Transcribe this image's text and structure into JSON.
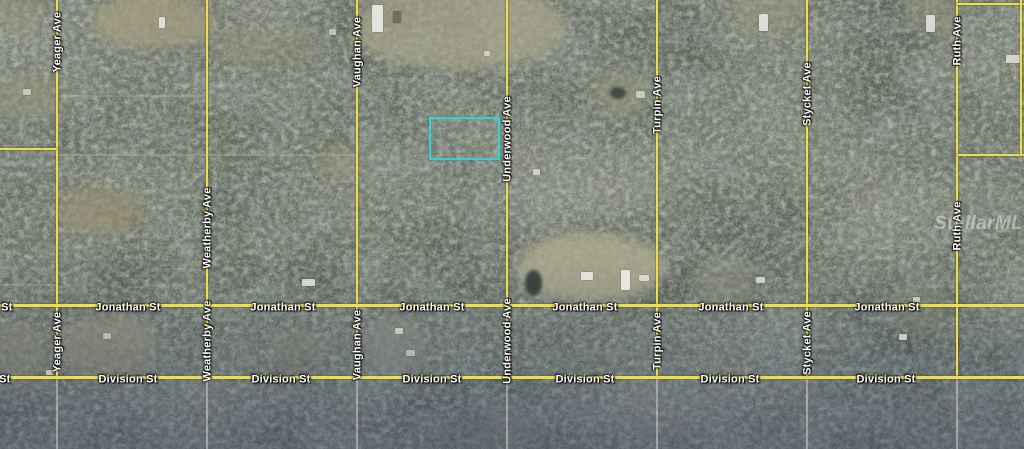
{
  "map": {
    "watermark": "StellarMLS",
    "watermark_pos": {
      "x": 934,
      "y": 213
    },
    "palette": {
      "forest_base": "#4d564c",
      "road_yellow": "#ecdf4e",
      "road_dirt": "#d0d0c4",
      "label_text": "#ffffff",
      "highlight": "#32d2d4"
    },
    "highlight_parcel": {
      "x": 429,
      "y": 117,
      "w": 71,
      "h": 43
    },
    "avenues": [
      {
        "name": "Yeager Ave",
        "x": 57,
        "label_ys": [
          42,
          342
        ]
      },
      {
        "name": "Weatherby Ave",
        "x": 207,
        "label_ys": [
          228,
          341
        ]
      },
      {
        "name": "Vaughan Ave",
        "x": 357,
        "label_ys": [
          52,
          345
        ]
      },
      {
        "name": "Underwood Ave",
        "x": 507,
        "label_ys": [
          139,
          341
        ]
      },
      {
        "name": "Turpin Ave",
        "x": 657,
        "label_ys": [
          105,
          341
        ]
      },
      {
        "name": "Stycket Ave",
        "x": 807,
        "label_ys": [
          94,
          343
        ]
      },
      {
        "name": "Ruth Ave",
        "x": 957,
        "label_ys": [
          41,
          226
        ]
      }
    ],
    "avenue_yellow_end_y": 379,
    "streets": [
      {
        "name": "Jonathan St",
        "y": 305,
        "label_xs": [
          -20,
          128,
          283,
          432,
          585,
          731,
          887
        ]
      },
      {
        "name": "Division St",
        "y": 377,
        "label_xs": [
          -19,
          128,
          281,
          432,
          585,
          730,
          886
        ]
      }
    ],
    "road_segments": [
      {
        "x": 0,
        "y": 148,
        "w": 57,
        "h": 2,
        "kind": "yellow"
      },
      {
        "x": 957,
        "y": 3,
        "w": 67,
        "h": 2,
        "kind": "yellow"
      },
      {
        "x": 957,
        "y": 154,
        "w": 67,
        "h": 2,
        "kind": "yellow"
      },
      {
        "x": 1020,
        "y": 0,
        "w": 2,
        "h": 156,
        "kind": "yellow"
      },
      {
        "x": 57,
        "y": 154,
        "w": 300,
        "h": 2,
        "kind": "dirt-faint"
      },
      {
        "x": 0,
        "y": 284,
        "w": 57,
        "h": 2,
        "kind": "dirt-faint"
      },
      {
        "x": 60,
        "y": 95,
        "w": 145,
        "h": 2,
        "kind": "dirt-faint"
      }
    ],
    "clearings": [
      {
        "x": 92,
        "y": -6,
        "w": 125,
        "h": 55,
        "color": "rgba(164,158,128,0.75)"
      },
      {
        "x": -12,
        "y": -10,
        "w": 60,
        "h": 36,
        "color": "rgba(150,146,120,0.45)"
      },
      {
        "x": 352,
        "y": -15,
        "w": 215,
        "h": 85,
        "color": "rgba(170,166,140,0.70)"
      },
      {
        "x": -8,
        "y": 75,
        "w": 70,
        "h": 45,
        "color": "rgba(150,146,120,0.55)"
      },
      {
        "x": 55,
        "y": 188,
        "w": 90,
        "h": 48,
        "color": "rgba(152,142,112,0.60)"
      },
      {
        "x": 516,
        "y": 234,
        "w": 150,
        "h": 68,
        "color": "rgba(178,172,144,0.80)"
      },
      {
        "x": 592,
        "y": 72,
        "w": 58,
        "h": 42,
        "color": "rgba(150,148,124,0.50)"
      },
      {
        "x": 322,
        "y": 146,
        "w": 36,
        "h": 34,
        "color": "rgba(160,156,130,0.50)"
      },
      {
        "x": 362,
        "y": 315,
        "w": 65,
        "h": 58,
        "color": "rgba(148,148,136,0.60)"
      },
      {
        "x": 55,
        "y": 315,
        "w": 100,
        "h": 62,
        "color": "rgba(158,152,126,0.60)"
      },
      {
        "x": -10,
        "y": 322,
        "w": 60,
        "h": 60,
        "color": "rgba(150,144,118,0.50)"
      },
      {
        "x": 270,
        "y": 330,
        "w": 55,
        "h": 42,
        "color": "rgba(140,136,114,0.45)"
      },
      {
        "x": 455,
        "y": 408,
        "w": 85,
        "h": 40,
        "color": "rgba(130,132,120,0.40)"
      },
      {
        "x": 690,
        "y": 258,
        "w": 65,
        "h": 45,
        "color": "rgba(150,146,120,0.40)"
      },
      {
        "x": 885,
        "y": 285,
        "w": 65,
        "h": 52,
        "color": "rgba(148,144,120,0.40)"
      },
      {
        "x": 205,
        "y": 28,
        "w": 125,
        "h": 38,
        "color": "rgba(150,146,122,0.40)"
      },
      {
        "x": 730,
        "y": -10,
        "w": 70,
        "h": 45,
        "color": "rgba(152,148,124,0.45)"
      },
      {
        "x": 905,
        "y": -10,
        "w": 60,
        "h": 45,
        "color": "rgba(150,146,122,0.45)"
      }
    ],
    "ponds": [
      {
        "x": 525,
        "y": 270,
        "w": 17,
        "h": 26,
        "color": "#3a443d"
      },
      {
        "x": 610,
        "y": 87,
        "w": 16,
        "h": 12,
        "color": "#414b44"
      }
    ],
    "buildings": [
      {
        "x": 159,
        "y": 17,
        "w": 6,
        "h": 11,
        "color": "#e0e0d8"
      },
      {
        "x": 23,
        "y": 89,
        "w": 8,
        "h": 6,
        "color": "#c6c6bb"
      },
      {
        "x": 329,
        "y": 29,
        "w": 7,
        "h": 6,
        "color": "#c0c0b4"
      },
      {
        "x": 372,
        "y": 5,
        "w": 11,
        "h": 27,
        "color": "#e3e3db"
      },
      {
        "x": 393,
        "y": 11,
        "w": 8,
        "h": 12,
        "color": "#70705f"
      },
      {
        "x": 484,
        "y": 51,
        "w": 6,
        "h": 5,
        "color": "#cfcfc4"
      },
      {
        "x": 759,
        "y": 14,
        "w": 9,
        "h": 17,
        "color": "#deded6"
      },
      {
        "x": 926,
        "y": 15,
        "w": 9,
        "h": 17,
        "color": "#d9d9d1"
      },
      {
        "x": 1006,
        "y": 55,
        "w": 16,
        "h": 8,
        "color": "#d3d3ca"
      },
      {
        "x": 636,
        "y": 91,
        "w": 9,
        "h": 7,
        "color": "#c9cabe"
      },
      {
        "x": 533,
        "y": 169,
        "w": 7,
        "h": 6,
        "color": "#d2d2c7"
      },
      {
        "x": 581,
        "y": 272,
        "w": 12,
        "h": 8,
        "color": "#e2e2da"
      },
      {
        "x": 621,
        "y": 270,
        "w": 9,
        "h": 20,
        "color": "#e6e6de"
      },
      {
        "x": 639,
        "y": 275,
        "w": 10,
        "h": 6,
        "color": "#d9d9cf"
      },
      {
        "x": 756,
        "y": 277,
        "w": 9,
        "h": 6,
        "color": "#cfcfc5"
      },
      {
        "x": 899,
        "y": 334,
        "w": 8,
        "h": 6,
        "color": "#cdcdc2"
      },
      {
        "x": 913,
        "y": 297,
        "w": 7,
        "h": 5,
        "color": "#c8c8bd"
      },
      {
        "x": 395,
        "y": 328,
        "w": 8,
        "h": 6,
        "color": "#c6c6bb"
      },
      {
        "x": 406,
        "y": 350,
        "w": 9,
        "h": 6,
        "color": "#b7b7ab"
      },
      {
        "x": 302,
        "y": 279,
        "w": 13,
        "h": 7,
        "color": "#d5d5cb"
      },
      {
        "x": 103,
        "y": 333,
        "w": 8,
        "h": 6,
        "color": "#b9b9ad"
      },
      {
        "x": 46,
        "y": 370,
        "w": 7,
        "h": 5,
        "color": "#c3c3b8"
      }
    ]
  }
}
